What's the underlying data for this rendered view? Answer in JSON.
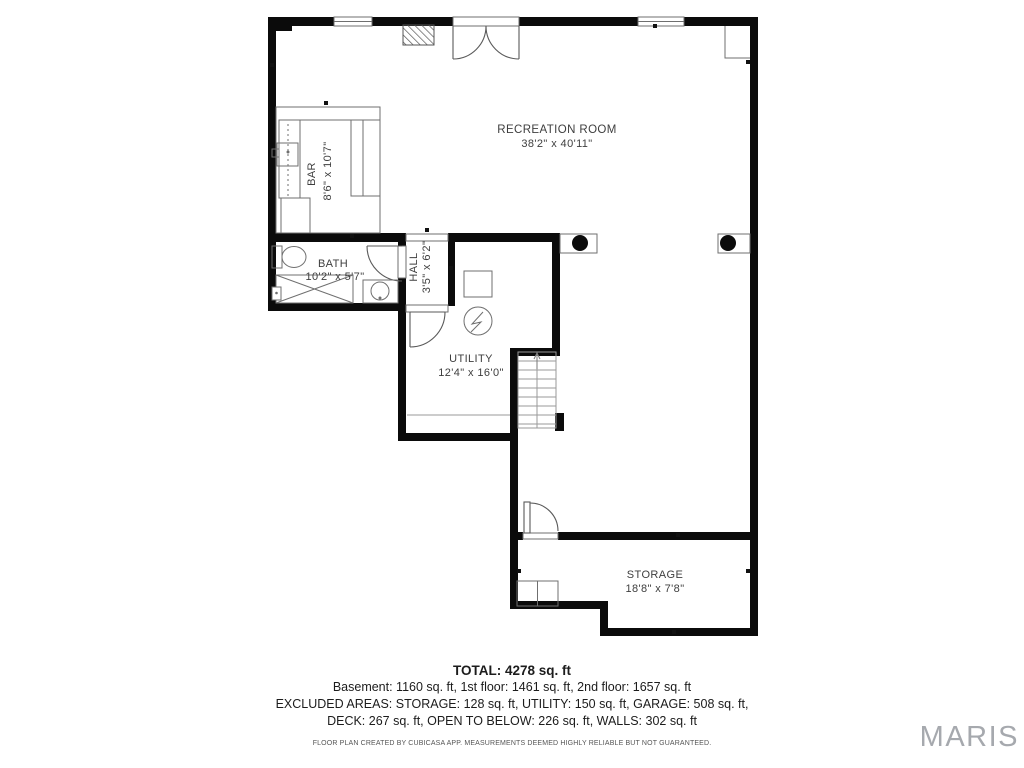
{
  "floor_plan": {
    "rooms": [
      {
        "name": "RECREATION ROOM",
        "dims": "38'2\" x 40'11\""
      },
      {
        "name": "BAR",
        "dims": "8'6\" x 10'7\""
      },
      {
        "name": "BATH",
        "dims": "10'2\" x 5'7\""
      },
      {
        "name": "HALL",
        "dims": "3'5\" x 6'2\""
      },
      {
        "name": "UTILITY",
        "dims": "12'4\" x 16'0\""
      },
      {
        "name": "STORAGE",
        "dims": "18'8\" x 7'8\""
      }
    ],
    "icons": [
      "window",
      "french-door",
      "door-swing",
      "chimney-hatch",
      "support-column",
      "stairs-up-arrow",
      "toilet",
      "shower",
      "sink",
      "bar-counter",
      "water-heater"
    ],
    "colors": {
      "wall": "#0b0b0b",
      "fixture_line": "#6f6f6f",
      "stair_line": "#9a9a9a",
      "label_text": "#3e3e3e",
      "watermark": "#a6a9ae"
    }
  },
  "summary": {
    "total": "TOTAL: 4278 sq. ft",
    "floors": "Basement: 1160 sq. ft, 1st floor: 1461 sq. ft, 2nd floor: 1657 sq. ft",
    "excluded_1": "EXCLUDED AREAS: STORAGE: 128 sq. ft, UTILITY: 150 sq. ft, GARAGE: 508 sq. ft,",
    "excluded_2": "DECK: 267 sq. ft, OPEN TO BELOW: 226 sq. ft, WALLS: 302 sq. ft",
    "disclaimer": "FLOOR PLAN CREATED BY CUBICASA APP. MEASUREMENTS DEEMED HIGHLY RELIABLE BUT NOT GUARANTEED."
  },
  "watermark": "MARIS"
}
